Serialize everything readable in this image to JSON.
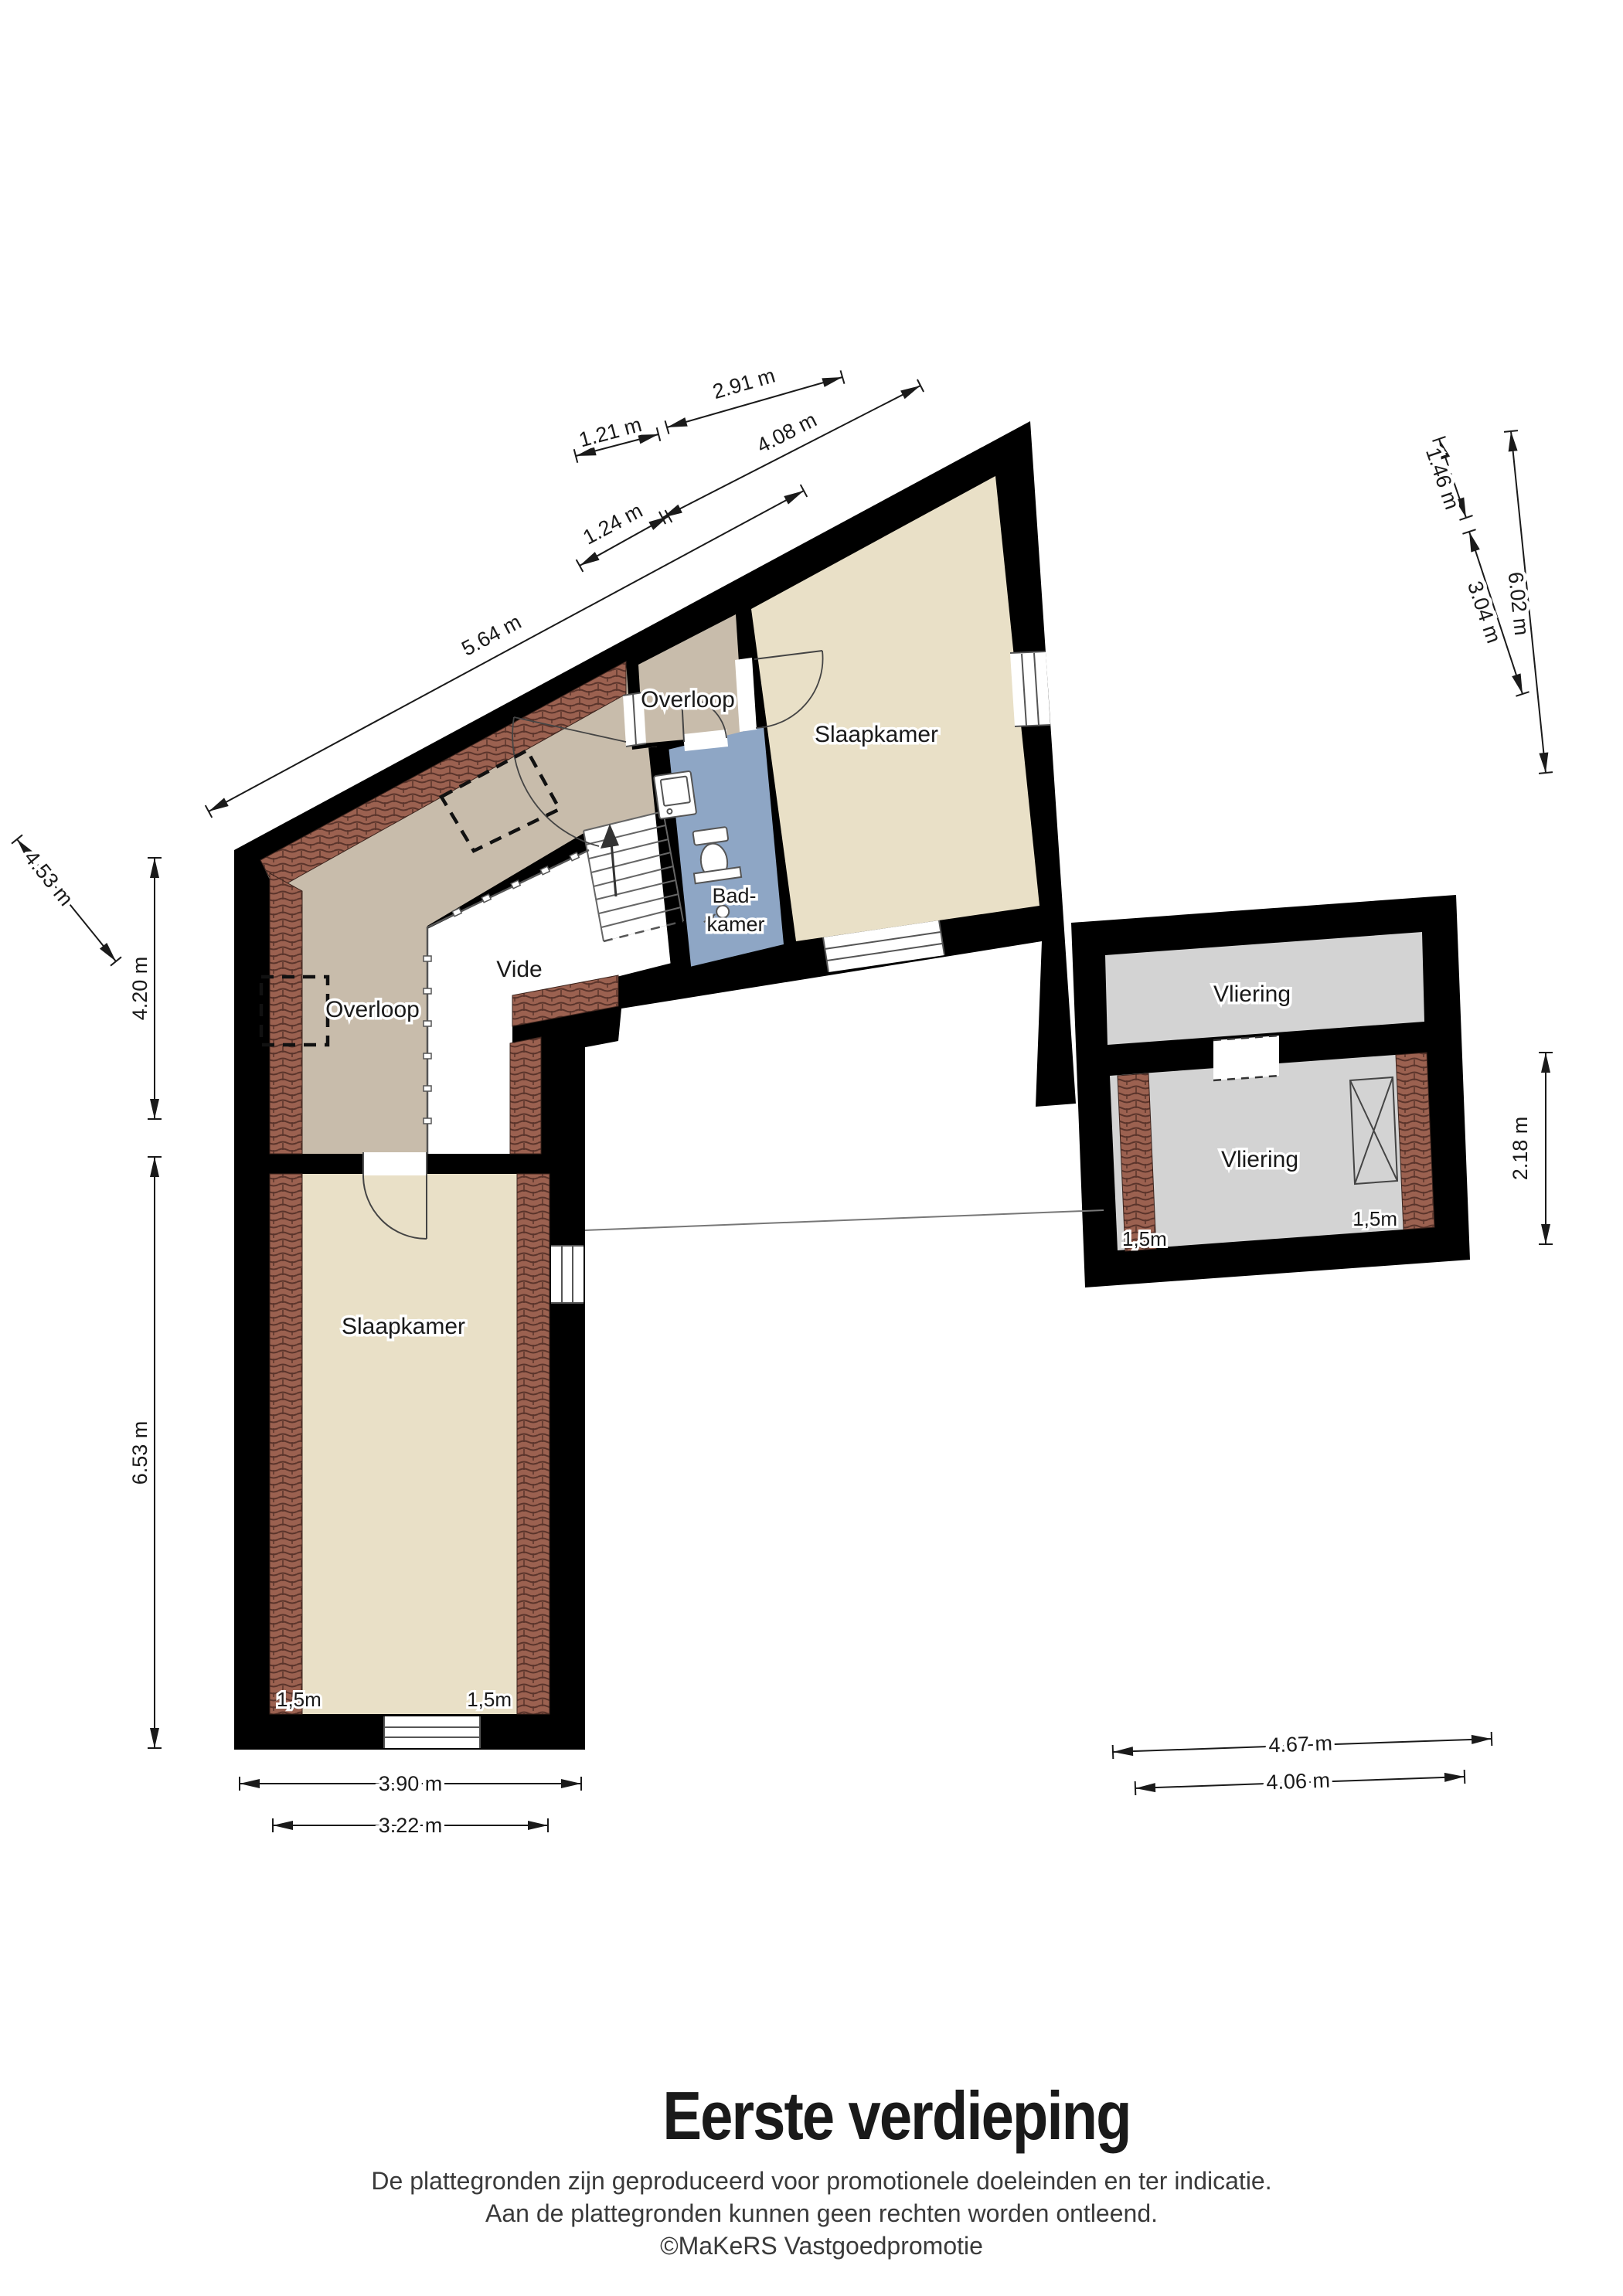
{
  "floorplan": {
    "title": "Eerste verdieping",
    "footer": {
      "line1": "De plattegronden zijn geproduceerd voor promotionele doeleinden en ter indicatie.",
      "line2": "Aan de plattegronden kunnen geen rechten worden ontleend.",
      "credit": "©MaKeRS Vastgoedpromotie"
    },
    "rooms": {
      "overloop_wing": "Overloop",
      "overloop_small": "Overloop",
      "slaapkamer_top": "Slaapkamer",
      "badkamer_line1": "Bad-",
      "badkamer_line2": "kamer",
      "vide": "Vide",
      "slaapkamer_bottom": "Slaapkamer",
      "vliering_top": "Vliering",
      "vliering_bottom": "Vliering"
    },
    "dimensions": {
      "top": [
        "2.91 m",
        "1.21 m",
        "4.08 m",
        "1.24 m",
        "5.64 m"
      ],
      "right": [
        "1.46 m",
        "3.04 m",
        "6.02 m"
      ],
      "annex_right": "2.18 m",
      "left": [
        "4.53 m",
        "4.20 m",
        "6.53 m"
      ],
      "bottom_left": [
        "3.90 m",
        "3.22 m"
      ],
      "bottom_right": [
        "4.67 m",
        "4.06 m"
      ]
    },
    "height_markers": {
      "slaapkamer_left": "1,5m",
      "slaapkamer_right": "1,5m",
      "vliering_left": "1,5m",
      "vliering_right": "1,5m"
    },
    "colors": {
      "wall": "#000000",
      "room_tan": "#c8bcab",
      "room_beige": "#e9e0c7",
      "room_blue": "#8ea6c5",
      "room_gray": "#d3d3d3",
      "brick": "#9b6150",
      "dimension": "#1a1a1a"
    }
  }
}
